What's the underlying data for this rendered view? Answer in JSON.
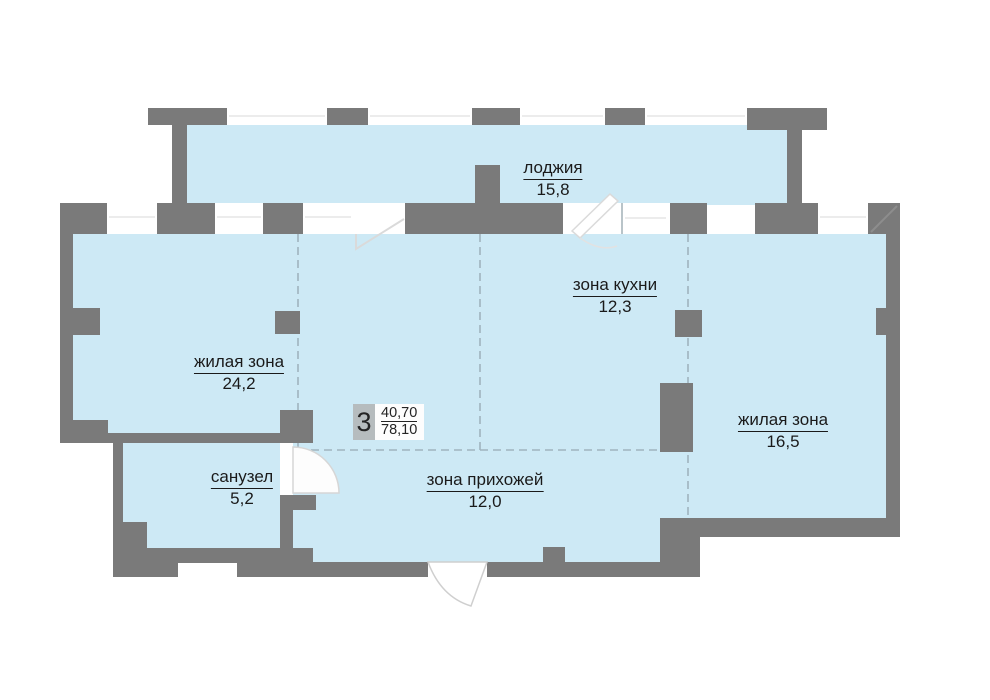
{
  "plan": {
    "title": "apartment floor plan",
    "apartment": {
      "rooms_count": "3",
      "living_area": "40,70",
      "total_area": "78,10"
    },
    "rooms": [
      {
        "id": "loggia",
        "name": "лоджия",
        "area": "15,8"
      },
      {
        "id": "kitchen-zone",
        "name": "зона кухни",
        "area": "12,3"
      },
      {
        "id": "living-zone-1",
        "name": "жилая зона",
        "area": "24,2"
      },
      {
        "id": "living-zone-2",
        "name": "жилая зона",
        "area": "16,5"
      },
      {
        "id": "bathroom",
        "name": "санузел",
        "area": "5,2"
      },
      {
        "id": "hallway-zone",
        "name": "зона прихожей",
        "area": "12,0"
      }
    ],
    "colors": {
      "floor": "#cde9f5",
      "wall": "#7a7a7a",
      "stat_box_gray": "#b6bcbe",
      "dashed_divider": "#a0b4be"
    }
  }
}
